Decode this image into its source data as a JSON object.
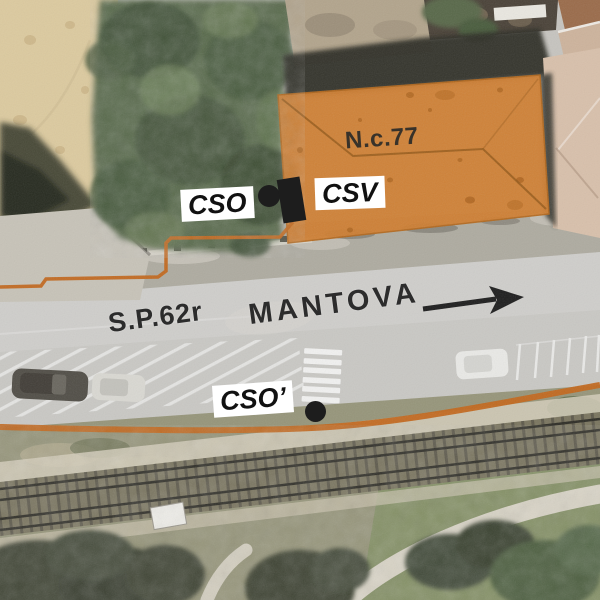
{
  "annotations": {
    "building": {
      "label": "N.c.77"
    },
    "points": {
      "cso": "CSO",
      "csv": "CSV",
      "cso_prime": "CSO’"
    },
    "road": {
      "name": "S.P.62r",
      "direction_city": "MANTOVA"
    }
  },
  "colors": {
    "building_highlight": "#D07E30",
    "route_line": "#C2671C",
    "marker": "#1D1D1D",
    "label_background": "#FFFFFF",
    "label_text": "#111111",
    "road_text": "#2C2C2C"
  }
}
